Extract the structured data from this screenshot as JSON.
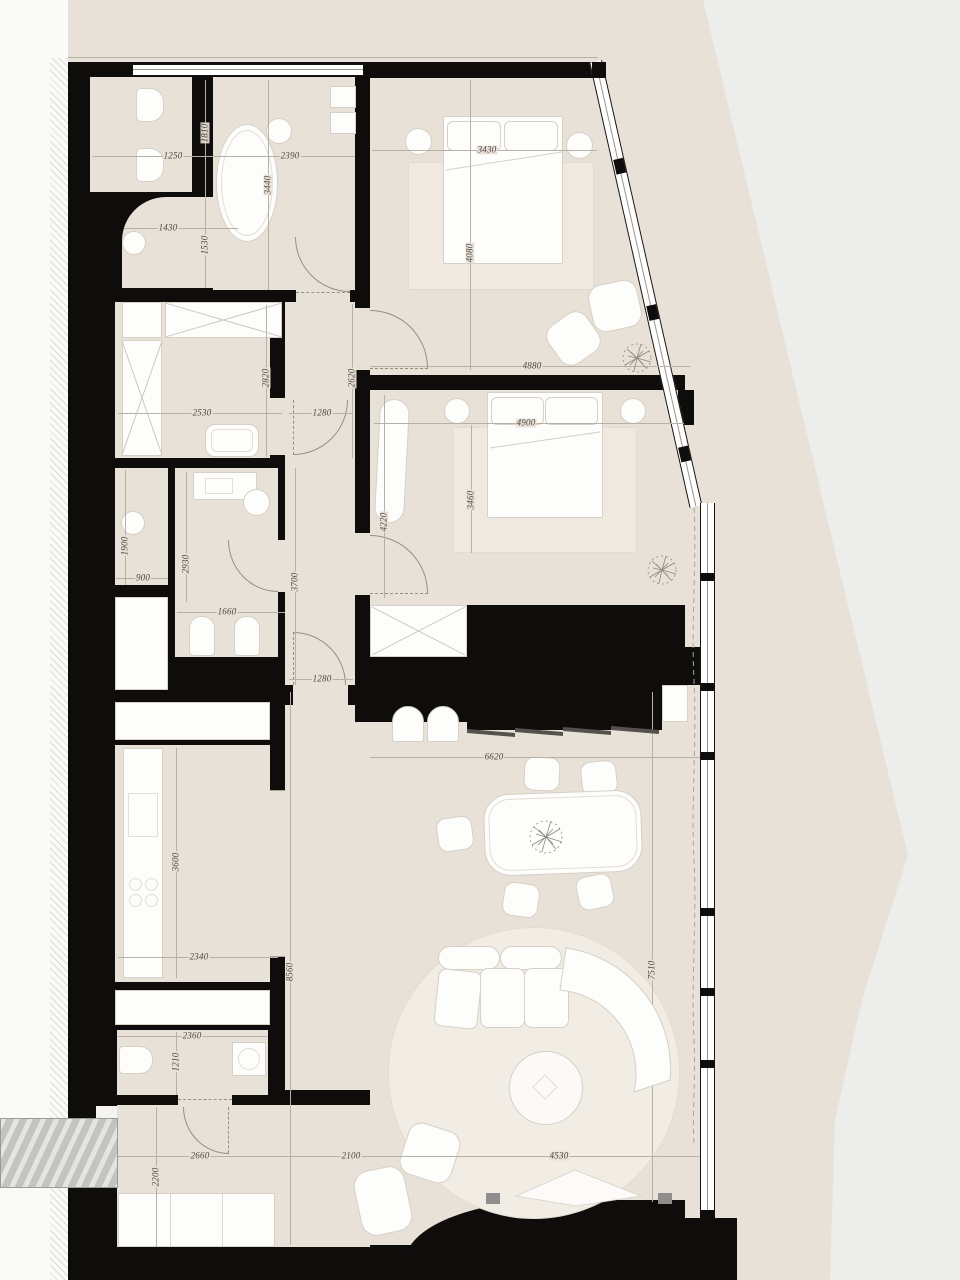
{
  "plan": {
    "kind": "apartment floor plan drawing",
    "units": "mm",
    "colors": {
      "wall": "#0e0d0c",
      "floor": "#e8e1d8",
      "outside": "#ededec",
      "furniture": "#fdfdfc",
      "rug": "#efe9e0",
      "dim_line": "#b7b0a4",
      "dim_text": "#4d4740",
      "entry_step": "#c4c3c1"
    }
  },
  "dims": {
    "d1810": "1810",
    "d1250": "1250",
    "d2390": "2390",
    "d3440": "3440",
    "d1430": "1430",
    "d1530": "1530",
    "d3430": "3430",
    "d4080": "4080",
    "d4880": "4880",
    "d2530": "2530",
    "d2820": "2820",
    "d2620": "2620",
    "d1280a": "1280",
    "d4900": "4900",
    "d3460": "3460",
    "d4220": "4220",
    "d1900": "1900",
    "d2930": "2930",
    "d900": "900",
    "d1660": "1660",
    "d3700": "3700",
    "d1280b": "1280",
    "d6620": "6620",
    "d3600": "3600",
    "d2340": "2340",
    "d8560": "8560",
    "d7510": "7510",
    "d2360": "2360",
    "d1210": "1210",
    "d2660": "2660",
    "d2200": "2200",
    "d2100": "2100",
    "d4530": "4530"
  }
}
